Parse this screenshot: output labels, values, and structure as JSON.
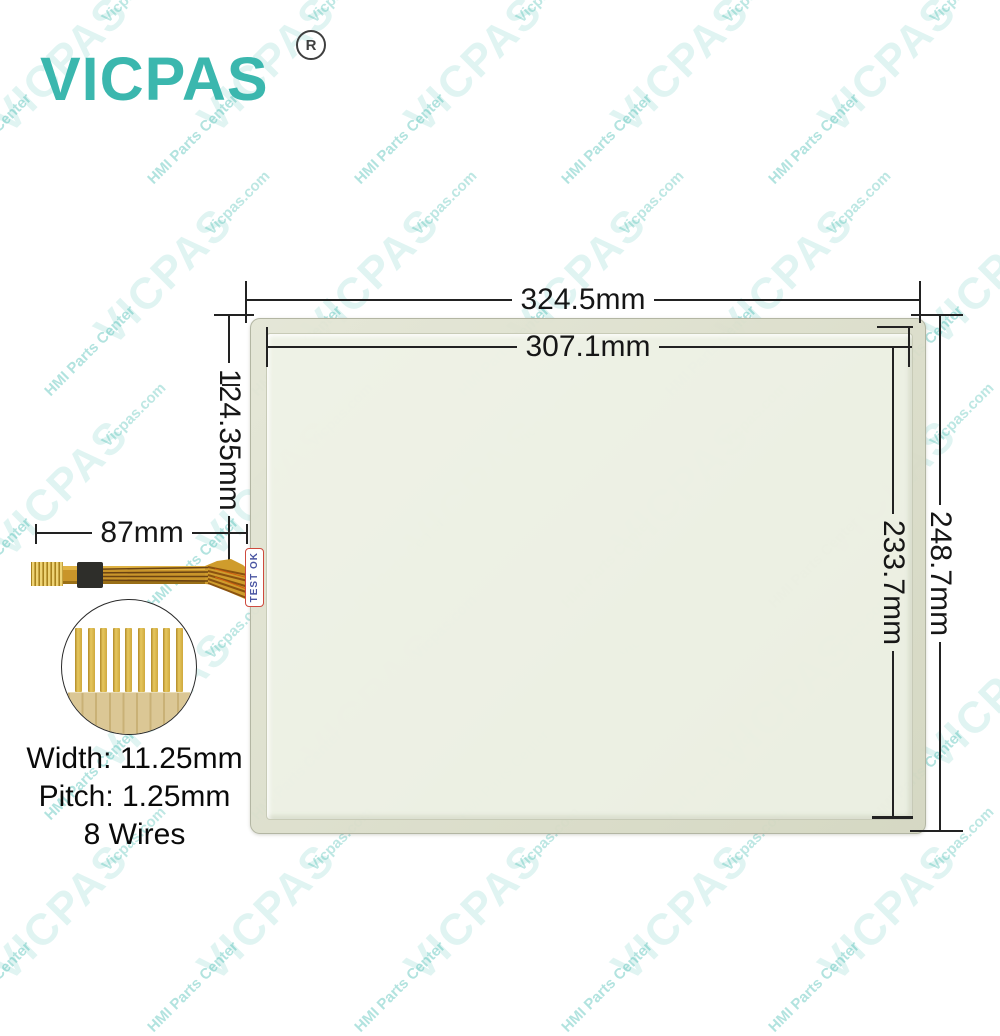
{
  "page": {
    "background": "#ffffff"
  },
  "brand": {
    "logo_text": "VICPAS",
    "registered_symbol": "R",
    "logo_color": "#3bb7ae"
  },
  "watermark": {
    "primary": "VICPAS",
    "secondary": "HMI Parts Center",
    "tertiary": "Vicpas.com",
    "color": "#3fb8b0"
  },
  "panel": {
    "frame_color": "#d7dac6",
    "surface_color": "#f2f5eb",
    "test_label": "TEST OK"
  },
  "dimensions": {
    "outer_width": "324.5mm",
    "inner_width": "307.1mm",
    "outer_height": "248.7mm",
    "inner_height": "233.7mm",
    "cable_vertical_offset": "124.35mm",
    "cable_length": "87mm"
  },
  "cable": {
    "wire_count": 8,
    "ribbon_color": "#c9952a",
    "stiffener_color": "#2e2e2a",
    "specs": {
      "width": "Width: 11.25mm",
      "pitch": "Pitch: 1.25mm",
      "wires": "8 Wires"
    }
  }
}
